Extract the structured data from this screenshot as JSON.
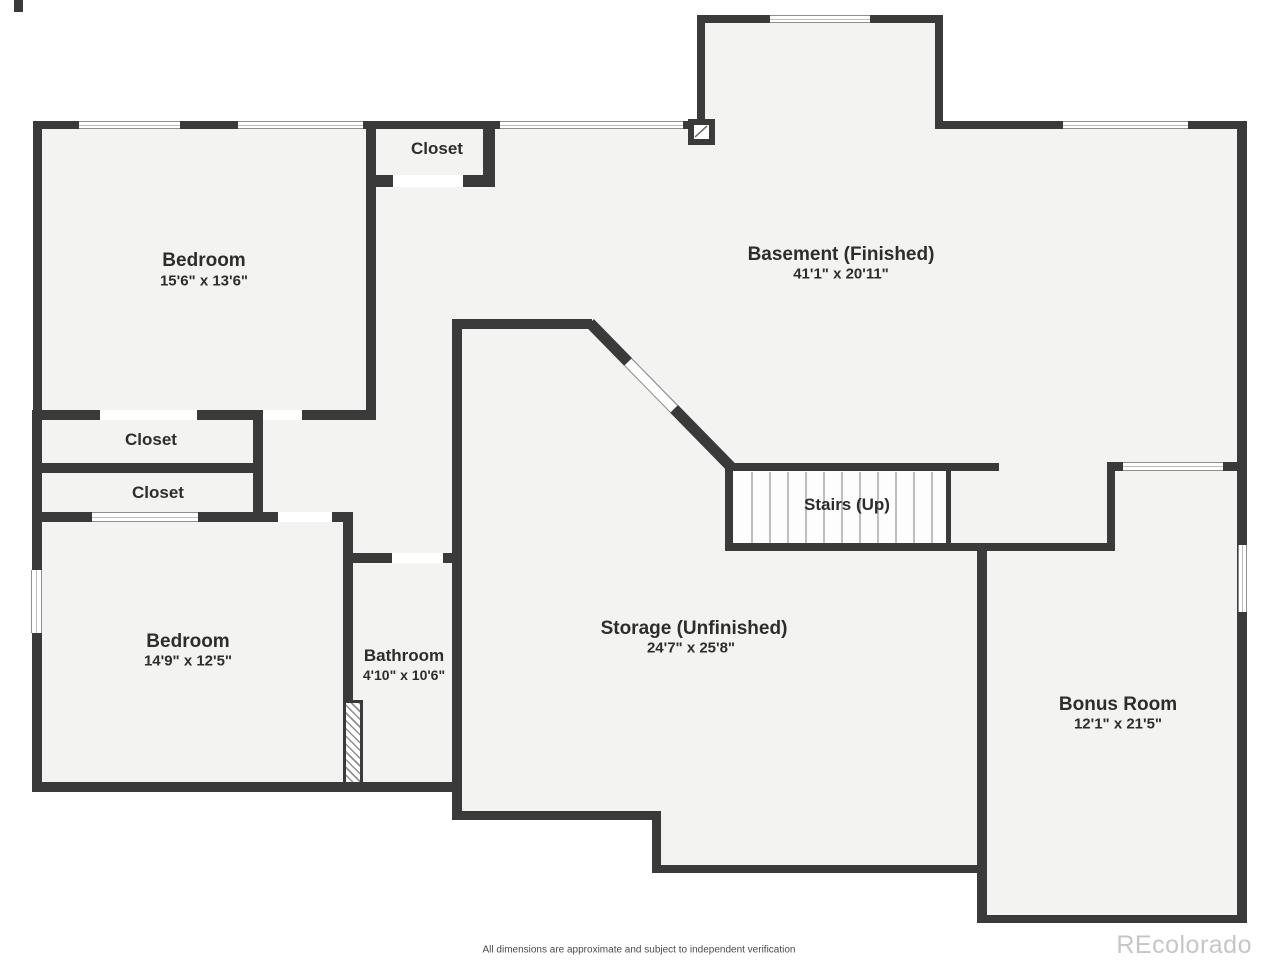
{
  "colors": {
    "wall": "#3a3a3a",
    "floor": "#f3f3f2",
    "background": "#ffffff",
    "label_text": "#2d2d2d",
    "window_frame": "#8f8f8f",
    "watermark": "#c6c6c6"
  },
  "rooms": {
    "bedroom_upper": {
      "name": "Bedroom",
      "dims": "15'6\" x 13'6\""
    },
    "closet_top": {
      "name": "Closet"
    },
    "basement": {
      "name": "Basement (Finished)",
      "dims": "41'1\" x 20'11\""
    },
    "closet_mid": {
      "name": "Closet"
    },
    "closet_low": {
      "name": "Closet"
    },
    "bedroom_lower": {
      "name": "Bedroom",
      "dims": "14'9\" x 12'5\""
    },
    "bathroom": {
      "name": "Bathroom",
      "dims": "4'10\" x 10'6\""
    },
    "storage": {
      "name": "Storage (Unfinished)",
      "dims": "24'7\" x 25'8\""
    },
    "stairs": {
      "name": "Stairs (Up)"
    },
    "bonus": {
      "name": "Bonus Room",
      "dims": "12'1\" x 21'5\""
    }
  },
  "footer": {
    "disclaimer": "All dimensions are approximate and subject to independent verification"
  },
  "watermark": {
    "text": "REcolorado"
  }
}
